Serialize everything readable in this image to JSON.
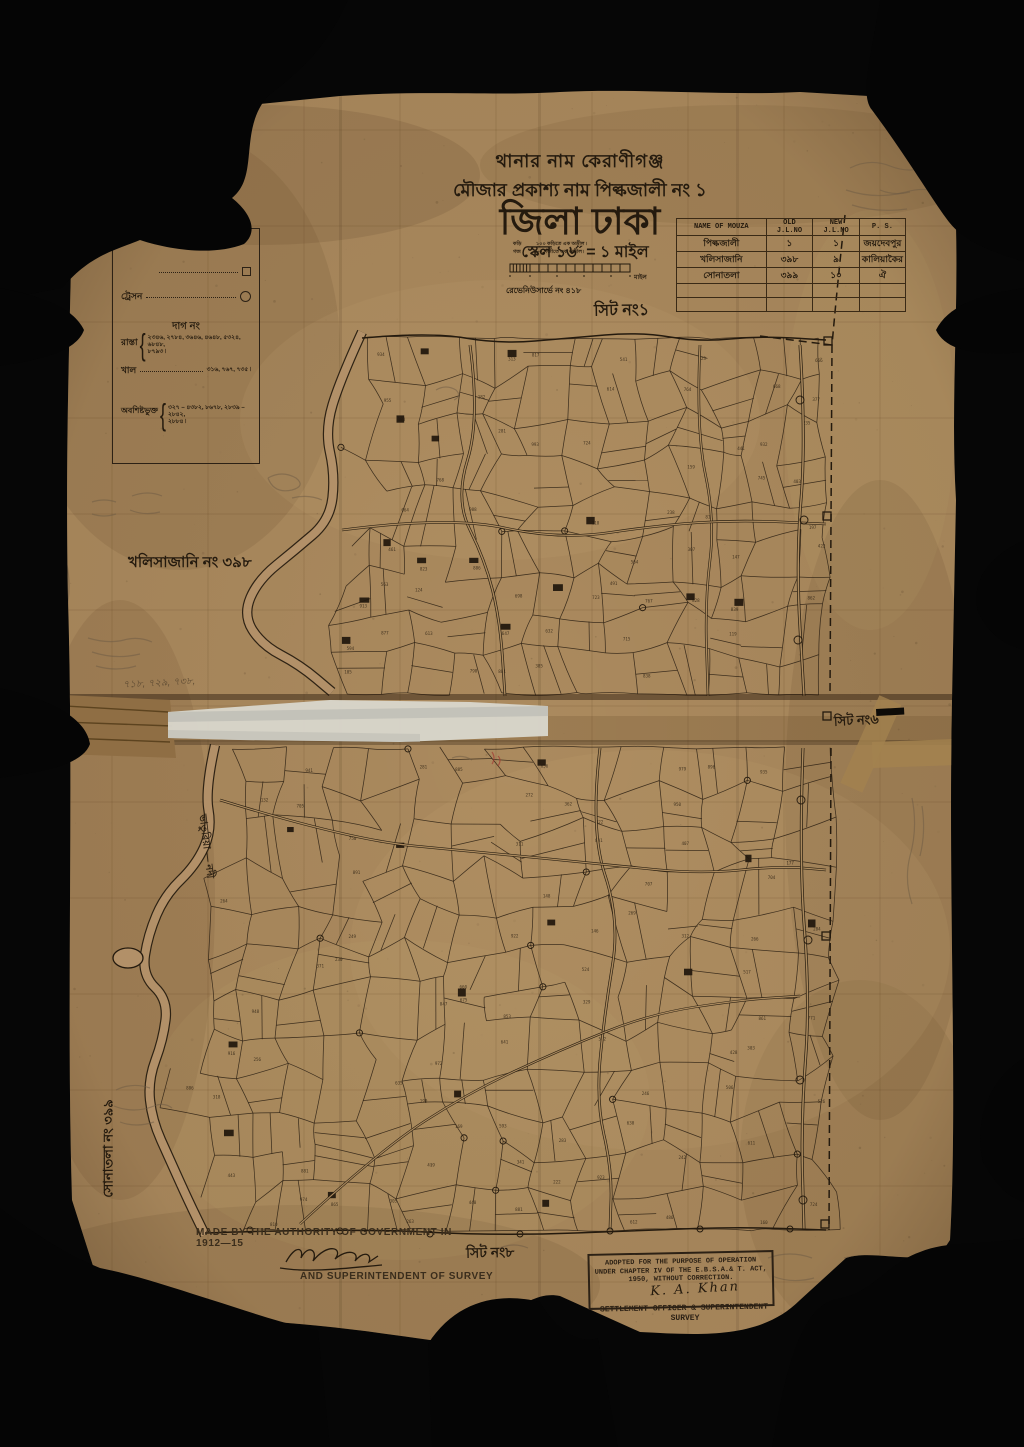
{
  "page": {
    "background_color": "#060606",
    "paper_color": "#ab8a5e",
    "ink_color": "#241a0e",
    "tape_white_color": "#d8d6cc",
    "tape_brown_color": "#a3824f"
  },
  "header": {
    "thana_line": "থানার নাম কেরাণীগঞ্জ",
    "mouza_line": "মৌজার প্রকাশ্য নাম পিল্কজালী নং ১",
    "district_line": "জিলা ঢাকা",
    "scale_line": "স্কেল ১৬˝ = ১ মাইল",
    "scale_caption_1": "১০০ কড়িতে এক অড়ীল ৷",
    "scale_caption_2": "৮০ গজীতে এক অড়ীল ৷",
    "scale_left_1": "কড়ি",
    "scale_left_2": "গজ",
    "scale_right": "মাইল",
    "revenue_line": "রেভেনিউসার্ভে নং ৪১৮",
    "sheet_label": "সিট নং১"
  },
  "mouza_table": {
    "headers": [
      "NAME OF MOUZA",
      "OLD J.L.NO",
      "NEW J.L.NO",
      "P. S."
    ],
    "rows": [
      [
        "পিল্কজালী",
        "১",
        "১",
        "জয়দেবপুর"
      ],
      [
        "খলিসাজানি",
        "৩৯৮",
        "৯",
        "কালিয়াকৈর"
      ],
      [
        "সোনাতলা",
        "৩৯৯",
        "১০",
        "ঐ"
      ]
    ]
  },
  "legend": {
    "title": "সূচক",
    "station_label": "ট্রেসন",
    "dag_header": "দাগ নং",
    "road_label": "রাস্তা",
    "road_numbers_1": "২৩৪৬, ২৭৮৪, ৩৬৪৬, ৪৬৪৮, ৫৩২৪, ৬৮৪৮,",
    "road_numbers_2": "৮৭৯৩ ৷",
    "khal_label": "খাল",
    "khal_numbers": "৩১৬, ৭৬৭, ৭৩৫ ৷",
    "remainder_label": "অবশিষ্টভুক্ত",
    "remainder_numbers_1": "৩২৭ – ৪৩৮২, ৮৬৭৮, ২৮৩৯ – ২৮৪২,",
    "remainder_numbers_2": "২৮৮৪ ৷"
  },
  "annotations": {
    "khalisajani": "খলিসাজানি নং ৩৯৮",
    "sonatola": "সোনাতলা নং ৩৯৯",
    "sheet6": "সিট নং৬",
    "sheet8": "সিট নং৮",
    "river_label": "ভাতুরিয়া — নদী",
    "pencil_numbers": "৭১৮, ৭২৯, ৭৩৮,"
  },
  "footer": {
    "made_by": "MADE BY THE AUTHORITY OF GOVERNMENT IN 1912—15",
    "superintendent": "AND SUPERINTENDENT OF SURVEY",
    "stamp_line1": "ADOPTED FOR THE PURPOSE OF OPERATION",
    "stamp_line2": "UNDER CHAPTER IV OF THE E.B.S.A.& T. ACT,",
    "stamp_line3": "1950, WITHOUT CORRECTION.",
    "stamp_signature": "K. A. Khan",
    "stamp_below1": "SETTLEMENT OFFICER & SUPERINTENDENT",
    "stamp_below2": "SURVEY"
  }
}
